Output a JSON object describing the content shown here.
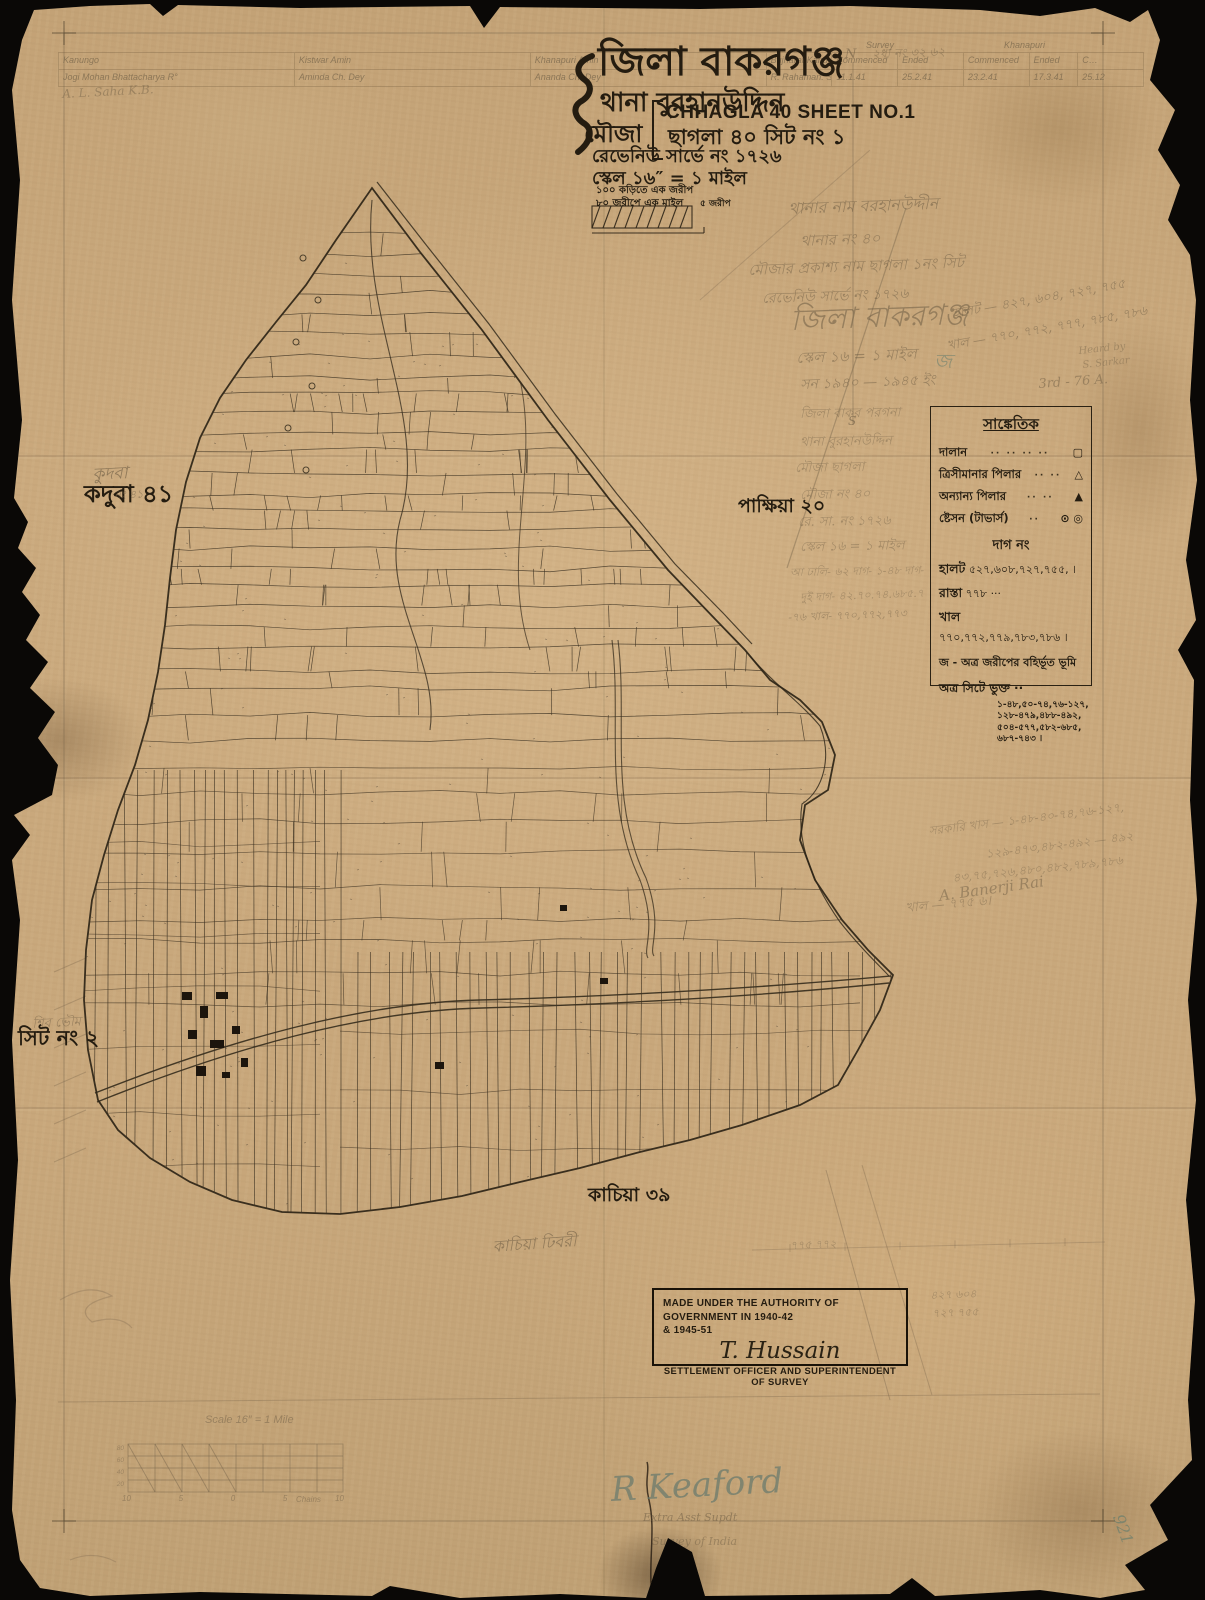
{
  "colors": {
    "paper": "#c9a97e",
    "ink": "#2c2416",
    "pencil": "#77654b",
    "teal_pencil": "#5c7a6d"
  },
  "title_block": {
    "district": "জিলা বাকরগঞ্জ",
    "thana": "থানা বুরহানউদ্দিন",
    "mouza_label": "মৌজা",
    "mouza_name_en": "CHHAGLA 40 SHEET NO.1",
    "mouza_name_bn": "ছাগলা ৪০ সিট নং ১",
    "revenue_survey": "রেভেনিউ সার্ভে নং ১৭২৬",
    "scale": "স্কেল ১৬″ = ১ মাইল",
    "conversion1": "১০০ কড়িতে এক জরীপ",
    "conversion2": "৮০ জরীপে এক মাইল",
    "bar_label": "৫ জরীপ"
  },
  "header_table": {
    "group_headers": [
      "Survey",
      "Khanapuri"
    ],
    "columns": [
      "Kanungo",
      "Kistwar Amin",
      "Khanapuri Amin",
      "Bujharat Kanungo",
      "Commenced",
      "Ended",
      "Commenced",
      "Ended",
      "C…"
    ],
    "values": [
      "Jogi Mohan Bhattacharya R°",
      "Aminda Ch. Dey",
      "Ananda Ch. Dey",
      "R. Rahaman. S.A",
      "11.1.41",
      "25.2.41",
      "23.2.41",
      "17.3.41",
      "25.12"
    ]
  },
  "legend": {
    "title": "সাঙ্কেতিক",
    "rows": [
      {
        "label": "দালান",
        "dots": "·· ·· ·· ··",
        "symbol": "▢"
      },
      {
        "label": "ত্রিসীমানার পিলার",
        "dots": "·· ··",
        "symbol": "△"
      },
      {
        "label": "অন্যান্য পিলার",
        "dots": "·· ··",
        "symbol": "▲"
      },
      {
        "label": "ষ্টেসন (টাভার্স)",
        "dots": "··",
        "symbol": "⊙ ◎"
      }
    ],
    "dag_heading": "দাগ নং",
    "entries": [
      {
        "label": "হালট",
        "value": "৫২৭,৬০৮,৭২৭,৭৫৫, ।"
      },
      {
        "label": "রাস্তা",
        "value": "৭৭৮ ···"
      },
      {
        "label": "খাল",
        "value": "৭৭০,৭৭২,৭৭৯,৭৮৩,৭৮৬ ।"
      }
    ],
    "note_j": "জ - অত্র জরীপের বহির্ভূত ভূমি",
    "sheet_included_label": "অত্র সিটে ভুক্ত ··",
    "sheet_included_lines": [
      "১-৪৮,৫০-৭৪,৭৬-১২৭,",
      "১২৮-৪৭৯,৪৮৮-৪৯২,",
      "৫০৪-৫৭৭,৫৮২-৬৮৫,",
      "৬৮৭-৭৪৩ ।"
    ]
  },
  "neighbors": {
    "west": "কদুবা ৪১",
    "east": "পাক্ষিয়া ২০",
    "southwest": "সিট নং ২",
    "south": "কাচিয়া ৩৯"
  },
  "stamp": {
    "line1": "MADE UNDER THE AUTHORITY OF GOVERNMENT IN 1940-42",
    "line2": "& 1945-51",
    "signature": "T. Hussain",
    "line3": "SETTLEMENT OFFICER AND SUPERINTENDENT OF SURVEY"
  },
  "signature_block": {
    "name": "R Keaford",
    "role": "Extra Asst Supdt",
    "org": "Survey of India"
  },
  "scale_diagram": {
    "title": "Scale 16″ = 1 Mile",
    "left_ticks": [
      "80",
      "60",
      "40",
      "20"
    ],
    "bottom_ticks": [
      "10",
      "5",
      "0",
      "5",
      "10"
    ],
    "unit": "Chains"
  },
  "annotations": [
    {
      "text": "২ধা নং ৩২ ৬২",
      "x": 872,
      "y": 48,
      "s": 12,
      "r": -2,
      "o": 0.45
    },
    {
      "text": "N",
      "x": 845,
      "y": 48,
      "s": 13,
      "r": 0,
      "o": 0.6
    },
    {
      "text": "S",
      "x": 848,
      "y": 415,
      "s": 12,
      "r": 0,
      "o": 0.6
    },
    {
      "text": "থানার নাম বরহানউদ্দীন",
      "x": 788,
      "y": 200,
      "s": 16,
      "r": -2,
      "o": 0.55
    },
    {
      "text": "থানার নং ৪০",
      "x": 800,
      "y": 233,
      "s": 15,
      "r": -2,
      "o": 0.5
    },
    {
      "text": "মৌজার প্রকাশ্য নাম ছাগলা ১নং সিট",
      "x": 748,
      "y": 262,
      "s": 15,
      "r": -2,
      "o": 0.5
    },
    {
      "text": "রেভেনিউ সার্ভে নং ১৭২৬",
      "x": 762,
      "y": 292,
      "s": 14,
      "r": -2,
      "o": 0.5
    },
    {
      "text": "জিলা বাকরগঞ্জ",
      "x": 790,
      "y": 305,
      "s": 29,
      "r": -2,
      "o": 0.55
    },
    {
      "text": "স্কেল ১৬ = ১ মাইল",
      "x": 796,
      "y": 350,
      "s": 15,
      "r": -2,
      "o": 0.5
    },
    {
      "text": "সন ১৯৪০ — ১৯৪৫ ইং",
      "x": 800,
      "y": 378,
      "s": 14,
      "r": -2,
      "o": 0.5
    },
    {
      "text": "হালট — ৪২৭, ৬০৪, ৭২৭, ৭৫৫",
      "x": 952,
      "y": 308,
      "s": 13,
      "r": -10,
      "o": 0.5
    },
    {
      "text": "খাল — ৭৭০, ৭৭২, ৭৭৭, ৭৮৫, ৭৮৬",
      "x": 946,
      "y": 340,
      "s": 13,
      "r": -10,
      "o": 0.5
    },
    {
      "text": "Heard by",
      "x": 1078,
      "y": 346,
      "s": 10,
      "r": -6,
      "o": 0.4
    },
    {
      "text": "S. Sarkar",
      "x": 1082,
      "y": 360,
      "s": 10,
      "r": -6,
      "o": 0.4
    },
    {
      "text": "3rd - 76 A.",
      "x": 1038,
      "y": 378,
      "s": 13,
      "r": -4,
      "o": 0.5
    },
    {
      "text": "জ",
      "x": 934,
      "y": 350,
      "s": 20,
      "r": 0,
      "o": 0.5,
      "cls": "teal"
    },
    {
      "text": "জিলা বাকর পরগনা",
      "x": 800,
      "y": 408,
      "s": 13,
      "r": -1,
      "o": 0.42
    },
    {
      "text": "থানা বুরহানউদ্দিন",
      "x": 800,
      "y": 436,
      "s": 13,
      "r": -1,
      "o": 0.42
    },
    {
      "text": "মৌজা ছাগলা",
      "x": 795,
      "y": 462,
      "s": 13,
      "r": -1,
      "o": 0.42
    },
    {
      "text": "মৌজা নং ৪০",
      "x": 800,
      "y": 489,
      "s": 13,
      "r": -1,
      "o": 0.42
    },
    {
      "text": "রে. সা. নং ১৭২৬",
      "x": 798,
      "y": 516,
      "s": 13,
      "r": -1,
      "o": 0.42
    },
    {
      "text": "স্কেল ১৬ = ১ মাইল",
      "x": 800,
      "y": 541,
      "s": 13,
      "r": -1,
      "o": 0.42
    },
    {
      "text": "আ ঢালি- ৬২ দাগ- ১-৪৮ দাগ-",
      "x": 790,
      "y": 567,
      "s": 11,
      "r": -1,
      "o": 0.4
    },
    {
      "text": "দুই দাগ- ৪২.৭০.৭৪.৬৮৫.৭",
      "x": 800,
      "y": 592,
      "s": 11,
      "r": -2,
      "o": 0.4
    },
    {
      "text": "-৭৬ খাল- ৭৭০,৭৭২,৭৭৩",
      "x": 788,
      "y": 612,
      "s": 11,
      "r": -2,
      "o": 0.45
    },
    {
      "text": "কুদবা",
      "x": 92,
      "y": 466,
      "s": 17,
      "r": -3,
      "o": 0.65
    },
    {
      "text": "নং ৪১",
      "x": 114,
      "y": 490,
      "s": 11,
      "r": -3,
      "o": 0.55
    },
    {
      "text": "শিব ভৌম",
      "x": 32,
      "y": 1018,
      "s": 13,
      "r": -3,
      "o": 0.5
    },
    {
      "text": "কাচিয়া ঢিবরী",
      "x": 492,
      "y": 1238,
      "s": 16,
      "r": -4,
      "o": 0.6
    },
    {
      "text": "সরকারি খাস — ১-৪৮-৪০-৭৪,৭৬-১২৭,",
      "x": 928,
      "y": 825,
      "s": 12,
      "r": -7,
      "o": 0.4
    },
    {
      "text": "১২৯-৪৭৩,৪৮২-৪৯২ — ৪৯২",
      "x": 985,
      "y": 848,
      "s": 12,
      "r": -7,
      "o": 0.4
    },
    {
      "text": "৪৩,৭৫,৭২৬,৪৮০,৪৮২,৭৮৯,৭৮৬",
      "x": 952,
      "y": 872,
      "s": 12,
      "r": -6,
      "o": 0.4
    },
    {
      "text": "খাল — ৭৭৫ ৬।",
      "x": 905,
      "y": 902,
      "s": 13,
      "r": -5,
      "o": 0.42
    },
    {
      "text": "A. Banerji Rai",
      "x": 938,
      "y": 888,
      "s": 15,
      "r": -8,
      "o": 0.5
    },
    {
      "text": "৪২৭  ৬০৪",
      "x": 930,
      "y": 1290,
      "s": 11,
      "r": -2,
      "o": 0.4
    },
    {
      "text": "৭২৭  ৭৫৫",
      "x": 932,
      "y": 1308,
      "s": 11,
      "r": -2,
      "o": 0.4
    },
    {
      "text": "৭৭৫  ৭৭২",
      "x": 790,
      "y": 1240,
      "s": 11,
      "r": -2,
      "o": 0.4
    },
    {
      "text": "921",
      "x": 1126,
      "y": 1512,
      "s": 16,
      "r": 70,
      "o": 0.6,
      "cls": "teal"
    },
    {
      "text": "A. L. Saha K.B.",
      "x": 62,
      "y": 88,
      "s": 12,
      "r": -3,
      "o": 0.45
    }
  ]
}
